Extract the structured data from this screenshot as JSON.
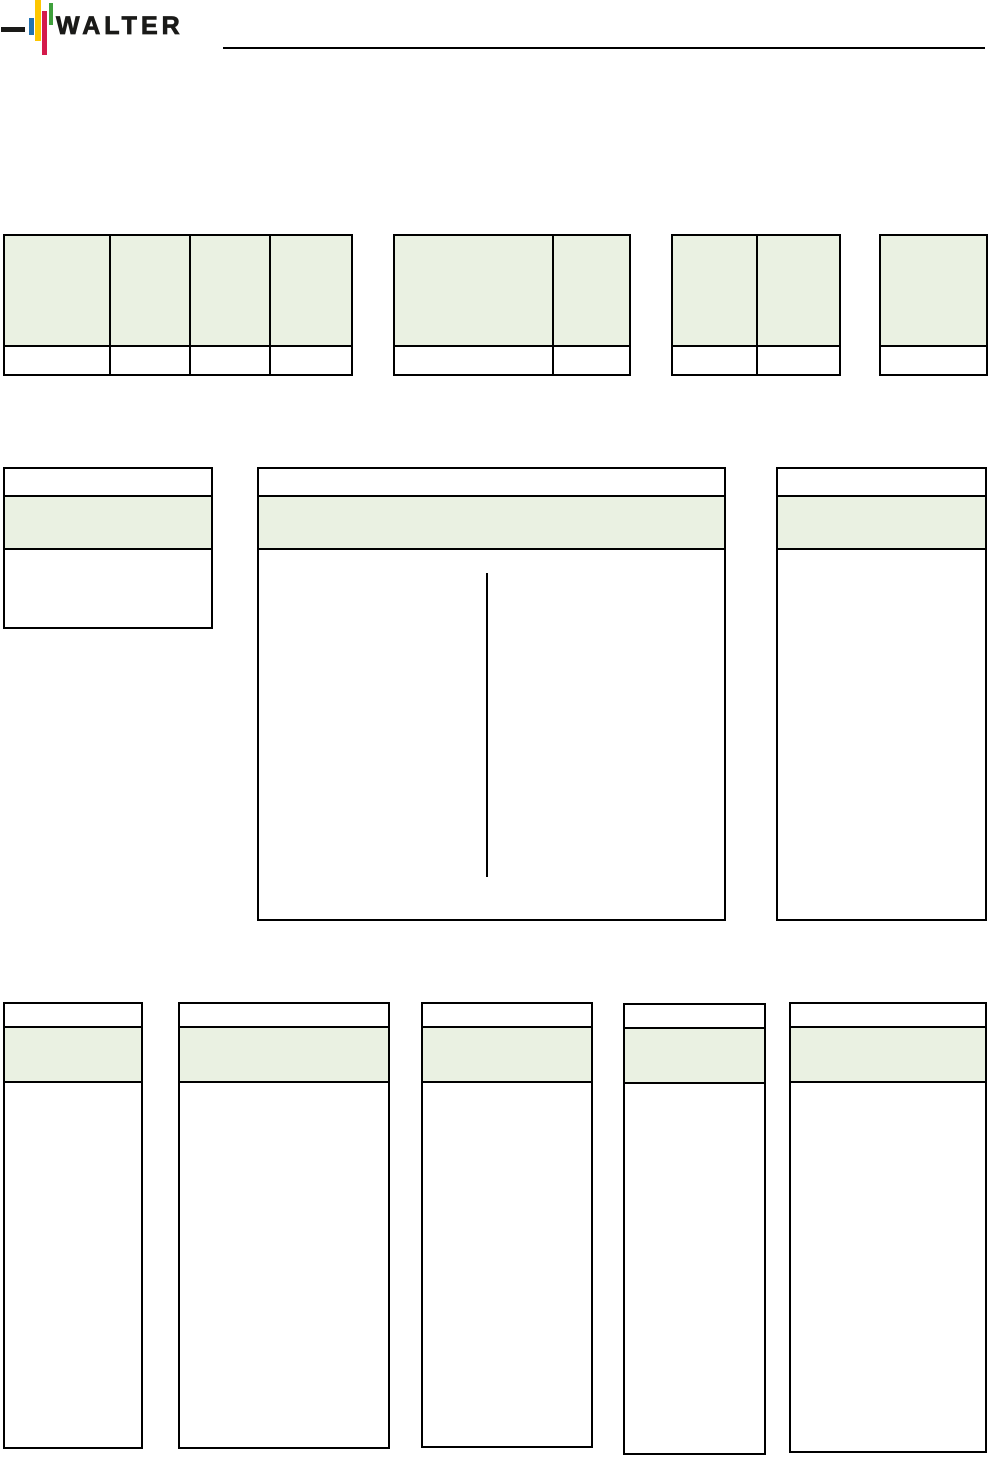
{
  "brand": {
    "name": "WALTER",
    "logo": {
      "dash_color": "#1a1a18",
      "bar_blue": "#2172b2",
      "bar_yellow": "#fdc600",
      "bar_red": "#d41a4b",
      "bar_green": "#3fa03c",
      "text_color": "#1a1a18"
    }
  },
  "theme": {
    "page_background": "#ffffff",
    "table_border_color": "#000000",
    "table_header_fill": "#eaf1e2",
    "rule_color": "#000000"
  },
  "layout_summary": {
    "top_tables": [
      {
        "name": "top-table-1",
        "columns": 4,
        "header_text": "",
        "body_text": ""
      },
      {
        "name": "top-table-2",
        "columns": 2,
        "header_text": "",
        "body_text": ""
      },
      {
        "name": "top-table-3",
        "columns": 2,
        "header_text": "",
        "body_text": ""
      },
      {
        "name": "top-table-4",
        "columns": 1,
        "header_text": "",
        "body_text": ""
      }
    ],
    "middle_boxes": [
      {
        "name": "middle-left-box",
        "header_text": ""
      },
      {
        "name": "middle-center-box",
        "header_text": "",
        "has_vertical_dimension_line": true
      },
      {
        "name": "middle-right-box",
        "header_text": ""
      }
    ],
    "bottom_boxes": [
      {
        "name": "bottom-box-1",
        "header_text": ""
      },
      {
        "name": "bottom-box-2",
        "header_text": ""
      },
      {
        "name": "bottom-box-3",
        "header_text": ""
      },
      {
        "name": "bottom-box-4",
        "header_text": ""
      },
      {
        "name": "bottom-box-5",
        "header_text": ""
      }
    ]
  }
}
